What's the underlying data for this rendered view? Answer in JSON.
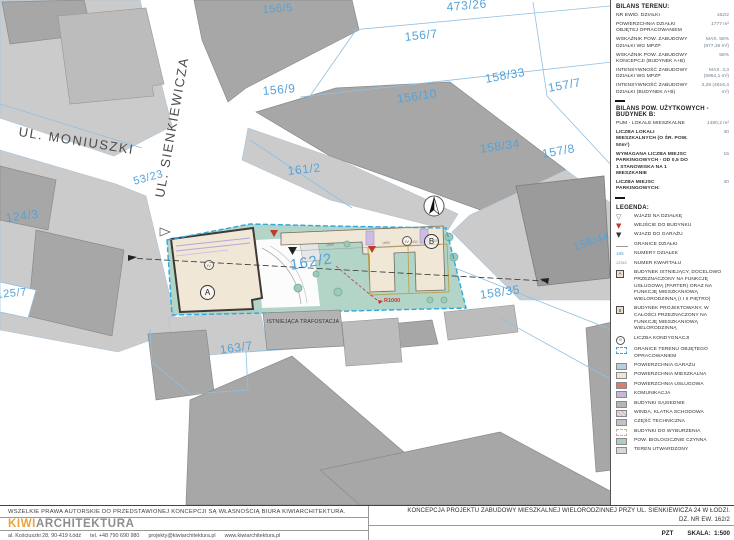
{
  "colors": {
    "parcel_label_blue": "#55a2d8",
    "site_boundary_cyan": "#2fa8dc",
    "bio_active_teal": "#a9cfc0",
    "residential_cream": "#efe6d0",
    "garage_blue": "#b7cede",
    "service_red": "#de7a70",
    "komunikacja_purple": "#c7b7dd",
    "kiwi_orange": "#e9a33c",
    "radius_red": "#cc3333"
  },
  "map": {
    "streets": [
      {
        "label": "UL. MONIUSZKI"
      },
      {
        "label": "UL. SIENKIEWICZA"
      }
    ],
    "parcels": [
      {
        "label": "156/5"
      },
      {
        "label": "473/26"
      },
      {
        "label": "156/7"
      },
      {
        "label": "156/9"
      },
      {
        "label": "156/10"
      },
      {
        "label": "158/33"
      },
      {
        "label": "157/7"
      },
      {
        "label": "161/2"
      },
      {
        "label": "158/34"
      },
      {
        "label": "157/8"
      },
      {
        "label": "53/23"
      },
      {
        "label": "124/3"
      },
      {
        "label": "125/7"
      },
      {
        "label": "158/44"
      },
      {
        "label": "158/35"
      },
      {
        "label": "163/7"
      },
      {
        "label": "162/2"
      }
    ],
    "site": {
      "building_a_label": "A",
      "building_b_label": "B",
      "storeys_label": "IV",
      "trafo_label": "ISTNIEJĄCA TRAFOSTACJA",
      "radius_label": "R1000",
      "dimension_labels": [
        {
          "text": "1850"
        },
        {
          "text": "1850"
        },
        {
          "text": "431"
        },
        {
          "text": "900"
        }
      ]
    }
  },
  "sidebar": {
    "bilans_terenu": {
      "title": "BILANS TERENU:",
      "rows": [
        {
          "label": "NR EWID. DZIAŁKI",
          "value": "162/2"
        },
        {
          "label": "POWIERZCHNIA DZIAŁKI OBJĘTEJ OPRACOWANIEM",
          "value": "1777 m²"
        },
        {
          "label": "WSKAŹNIK POW. ZABUDOWY DZIAŁKI WG MPZP",
          "value": "MAX. 55% (977,35 m²)"
        },
        {
          "label": "WSKAŹNIK POW. ZABUDOWY KONCEPCJI (BUDYNEK A+B)",
          "value": "55%"
        },
        {
          "label": "INTENSYWNOŚĆ ZABUDOWY DZIAŁKI WG MPZP",
          "value": "MAX. 3,3 (5864,1 m²)"
        },
        {
          "label": "INTENSYWNOŚĆ ZABUDOWY DZIAŁKI (BUDYNEK A+B)",
          "value": "3,28 (4816,4 m²)"
        }
      ]
    },
    "bilans_pow": {
      "title": "BILANS POW. UŻYTKOWYCH - BUDYNEK B:",
      "rows": [
        {
          "label": "PUM - LOKALE MIESZKALNE",
          "value": "1480,2 m²"
        },
        {
          "label": "LICZBA LOKALI MIESZKALNYCH (O ŚR. POW. 50m²)",
          "value": "30"
        },
        {
          "label": "WYMAGANA LICZBA MIEJSC PARKINGOWYCH - OD 0,5 DO 1 STANOWISKA NA 1 MIESZKANIE",
          "value": "15"
        },
        {
          "label": "LICZBA MIEJSC PARKINGOWYCH:",
          "value": "40"
        }
      ]
    },
    "legend": {
      "title": "LEGENDA:",
      "items": [
        {
          "label": "WJAZD NA DZIAŁKĘ"
        },
        {
          "label": "WEJŚCIE DO BUDYNKU"
        },
        {
          "label": "WJAZD DO GARAŻU"
        },
        {
          "label": "GRANICE DZIAŁKI"
        },
        {
          "label": "NUMERY DZIAŁEK",
          "sample": "186"
        },
        {
          "label": "NUMER KWARTAŁU",
          "sample": "12345"
        },
        {
          "label": "BUDYNEK ISTNIEJĄCY, DOCELOWO PRZEZNACZONY NA FUNKCJĘ USŁUGOWĄ (PARTER) ORAZ NA FUNKCJĘ MIESZKANIOWĄ WIELORODZINNĄ (I I II PIĘTRO)",
          "sample": "A"
        },
        {
          "label": "BUDYNEK PROJEKTOWANY, W CAŁOŚCI PRZEZNACZONY NA FUNKCJĘ MIESZKANIOWĄ WIELORODZINNĄ",
          "sample": "B"
        },
        {
          "label": "LICZBA KONDYGNACJI",
          "sample": "IV"
        },
        {
          "label": "GRANICE TERENU OBJĘTEGO OPRACOWANIEM"
        },
        {
          "label": "POWIERZCHNIA GARAŻU"
        },
        {
          "label": "POWIERZCHNIA MIESZKALNA"
        },
        {
          "label": "POWIERZCHNIA USŁUGOWA"
        },
        {
          "label": "KOMUNIKACJA"
        },
        {
          "label": "BUDYNKI SĄSIEDNIE"
        },
        {
          "label": "WINDA, KLATKA SCHODOWA"
        },
        {
          "label": "CZĘŚĆ TECHNICZNA"
        },
        {
          "label": "BUDYNKI DO WYBURZENIA"
        },
        {
          "label": "POW. BIOLOGICZNIE CZYNNA"
        },
        {
          "label": "TEREN UTWARDZONY"
        }
      ]
    }
  },
  "footer": {
    "copyright": "WSZELKIE PRAWA AUTORSKIE DO PRZEDSTAWIONEJ KONCEPCJI SĄ WŁASNOŚCIĄ BIURA KIWIARCHITEKTURA.",
    "logo_kiwi": "KIWI",
    "logo_rest": "ARCHITEKTURA",
    "address_items": [
      {
        "text": "al. Kościuszki 28, 90-419 Łódź"
      },
      {
        "text": "tel. +48 790 690 980"
      },
      {
        "text": "projekty@kiwiarchitektura.pl"
      },
      {
        "text": "www.kiwiarchitektura.pl"
      }
    ],
    "title_line1": "KONCEPCJA PROJEKTU ZABUDOWY MIESZKALNEJ WIELORODZINNEJ PRZY UL. SIENKIEWICZA 24 W ŁODZI.",
    "title_line2": "DZ. NR EW. 162/2",
    "drawing_code": "PZT",
    "scale_label": "SKALA:",
    "scale_value": "1:500"
  }
}
